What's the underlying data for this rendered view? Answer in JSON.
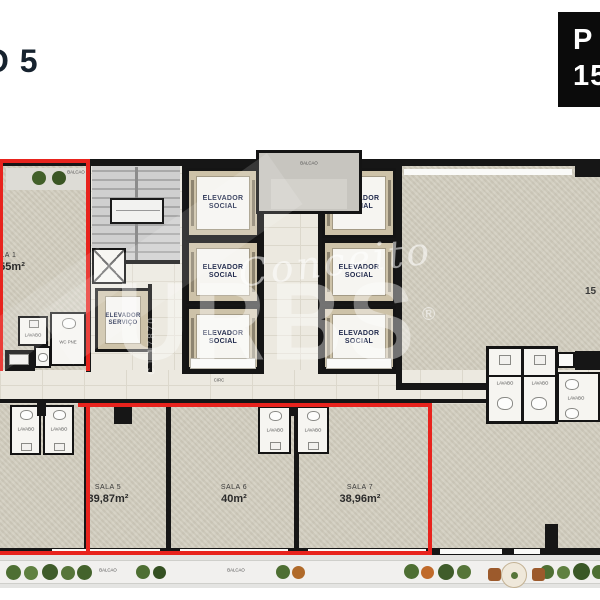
{
  "title": {
    "text": "O 5"
  },
  "badge": {
    "line1": "P",
    "line2": "15"
  },
  "watermark": {
    "script": "Conceito",
    "brand": "URBS",
    "reg": "®",
    "registry": "CJ 17870"
  },
  "labels": {
    "elevator_social_1": "ELEVADOR",
    "elevator_social_2": "SOCIAL",
    "elevator_service_1": "ELEVADOR",
    "elevator_service_2": "SERVIÇO",
    "balcao": "BALCÃO",
    "circ": "CIRC",
    "lavabo": "LAVABO",
    "wc_pne": "WC PNE",
    "partial_area_right": "15"
  },
  "rooms": {
    "sala1": {
      "name": "SALA 1",
      "area": "0,55m²"
    },
    "sala5": {
      "name": "SALA 5",
      "area": "39,87m²"
    },
    "sala6": {
      "name": "SALA 6",
      "area": "40m²"
    },
    "sala7": {
      "name": "SALA 7",
      "area": "38,96m²"
    }
  },
  "colors": {
    "outline": "#e8231d",
    "wall": "#161616",
    "floor": "#d4d0c2",
    "hall": "#ece9e0",
    "title": "#16222e"
  }
}
